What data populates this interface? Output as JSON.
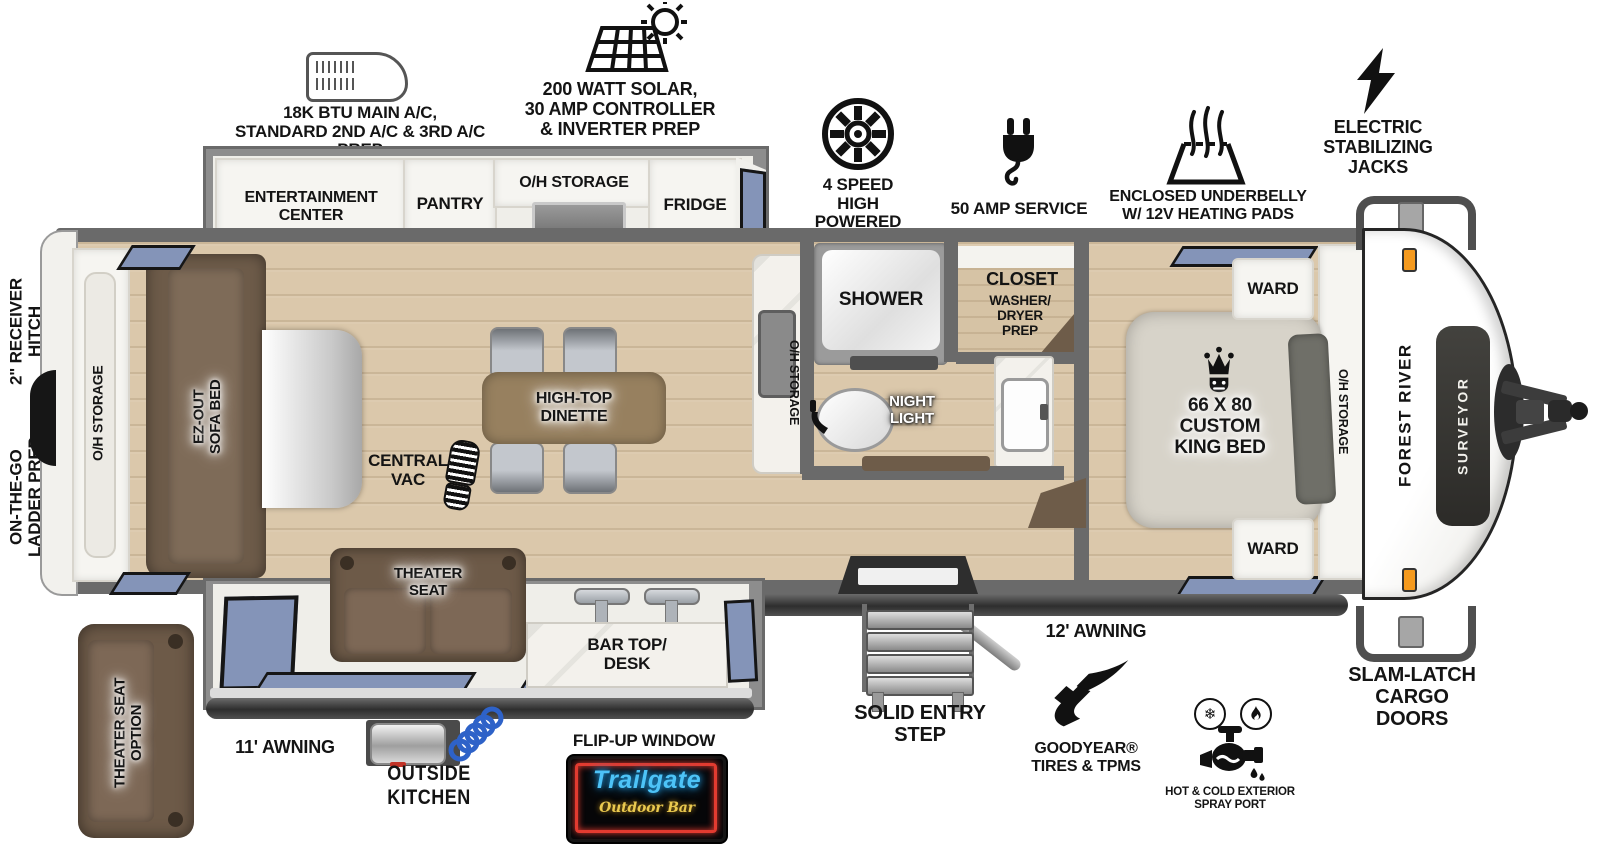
{
  "callouts": {
    "ac": "18K BTU MAIN A/C,\nSTANDARD 2ND A/C & 3RD A/C PREP",
    "solar": "200 WATT SOLAR,\n30 AMP CONTROLLER\n& INVERTER PREP",
    "fan": "4 SPEED\nHIGH POWERED\nBATH FAN",
    "amp": "50 AMP SERVICE",
    "underbelly": "ENCLOSED UNDERBELLY\nW/ 12V HEATING PADS",
    "jacks": "ELECTRIC\nSTABILIZING\nJACKS",
    "hitch": "2\" RECEIVER\nHITCH",
    "ladder": "ON-THE-GO\nLADDER PREP",
    "awning11": "11' AWNING",
    "awning12": "12' AWNING",
    "outside_kitchen": "OUTSIDE KITCHEN",
    "flip_window": "FLIP-UP WINDOW",
    "entry_step": "SOLID ENTRY\nSTEP",
    "goodyear": "GOODYEAR®\nTIRES & TPMS",
    "spray_port": "HOT & COLD EXTERIOR\nSPRAY PORT",
    "slam_latch": "SLAM-LATCH\nCARGO DOORS"
  },
  "interior": {
    "entertainment": "ENTERTAINMENT\nCENTER",
    "fireplace": "FIREPLACE",
    "pantry": "PANTRY",
    "oh_storage_kitchen": "O/H STORAGE",
    "fridge": "FRIDGE",
    "oh_storage_rear": "O/H STORAGE",
    "sofa": "EZ-OUT\nSOFA BED",
    "dinette": "HIGH-TOP\nDINETTE",
    "central_vac": "CENTRAL\nVAC",
    "oh_storage_island": "O/H STORAGE",
    "shower": "SHOWER",
    "night_light": "NIGHT\nLIGHT",
    "closet": "CLOSET",
    "washer_dryer": "WASHER/\nDRYER\nPREP",
    "king_bed": "66 X 80\nCUSTOM\nKING BED",
    "ward1": "WARD",
    "ward2": "WARD",
    "oh_storage_bed": "O/H STORAGE",
    "theater_seat": "THEATER\nSEAT",
    "bar_top": "BAR TOP/\nDESK",
    "theater_option": "THEATER SEAT\nOPTION"
  },
  "branding": {
    "make": "FOREST RIVER",
    "model": "SURVEYOR",
    "sign_title": "Trailgate",
    "sign_subtitle": "Outdoor Bar"
  },
  "colors": {
    "wall": "#6a6a6a",
    "floor": "#dbc8ab",
    "window_blue": "#8494b8",
    "fireplace_orange": "#f2990f",
    "furniture_brown": "#6f5c4a",
    "neon_red": "#e23b30",
    "neon_blue": "#4dc3f7",
    "neon_yellow": "#eac94f"
  }
}
